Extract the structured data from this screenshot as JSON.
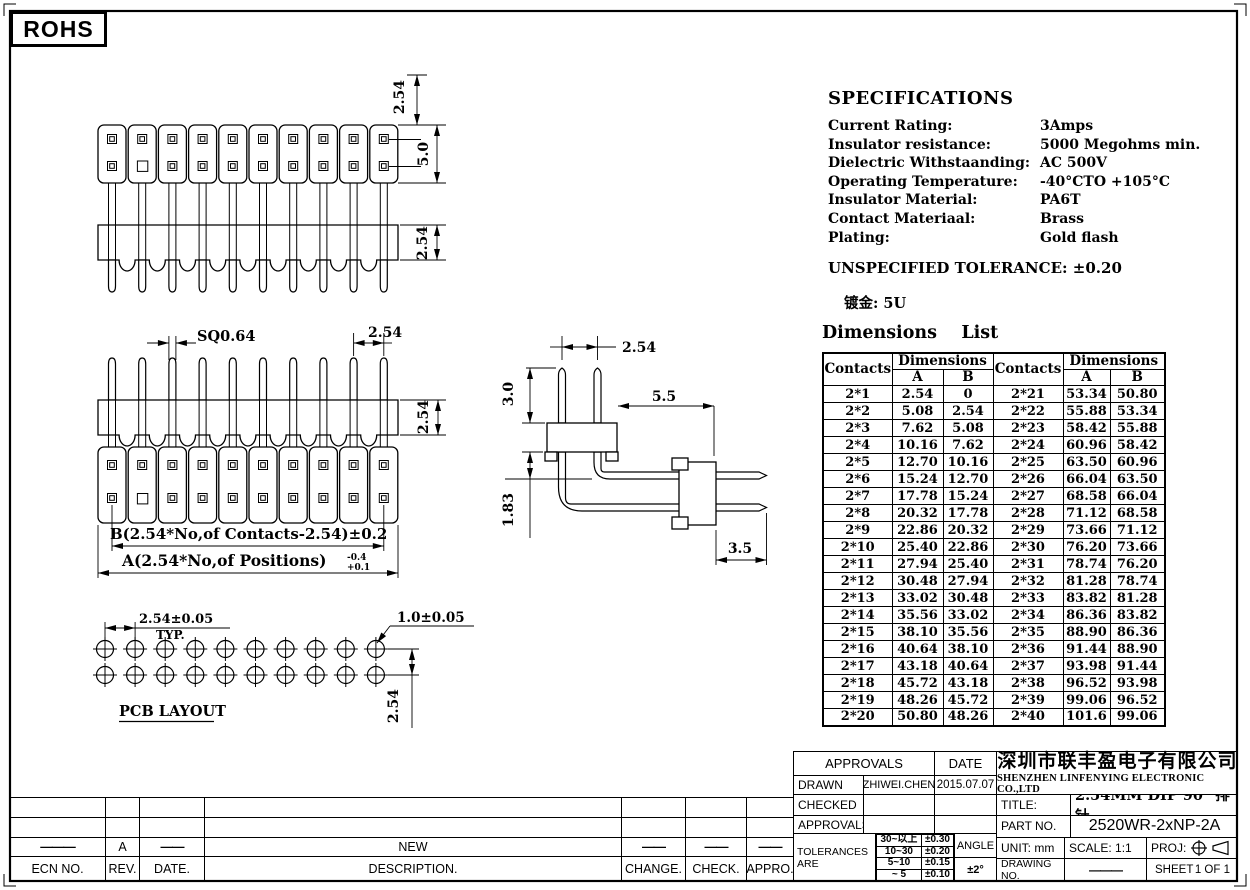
{
  "sheet": {
    "rohs": "ROHS"
  },
  "specs": {
    "title": "SPECIFICATIONS",
    "rows": [
      {
        "label": "Current Rating:",
        "value": "3Amps"
      },
      {
        "label": "Insulator resistance:",
        "value": "5000 Megohms min."
      },
      {
        "label": "Dielectric Withstaanding:",
        "value": "AC 500V"
      },
      {
        "label": "Operating Temperature:",
        "value": "-40°CTO +105°C"
      },
      {
        "label": "Insulator Material:",
        "value": "PA6T"
      },
      {
        "label": "Contact Materiaal:",
        "value": "Brass"
      },
      {
        "label": "Plating:",
        "value": "Gold flash"
      }
    ],
    "unspecified_tolerance": "UNSPECIFIED TOLERANCE: ±0.20",
    "plating_note": "镀金: 5U"
  },
  "dimensions_list": {
    "title": "Dimensions    List",
    "col_contacts": "Contacts",
    "col_dimensions": "Dimensions",
    "col_a": "A",
    "col_b": "B",
    "rows": [
      [
        "2*1",
        "2.54",
        "0",
        "2*21",
        "53.34",
        "50.80"
      ],
      [
        "2*2",
        "5.08",
        "2.54",
        "2*22",
        "55.88",
        "53.34"
      ],
      [
        "2*3",
        "7.62",
        "5.08",
        "2*23",
        "58.42",
        "55.88"
      ],
      [
        "2*4",
        "10.16",
        "7.62",
        "2*24",
        "60.96",
        "58.42"
      ],
      [
        "2*5",
        "12.70",
        "10.16",
        "2*25",
        "63.50",
        "60.96"
      ],
      [
        "2*6",
        "15.24",
        "12.70",
        "2*26",
        "66.04",
        "63.50"
      ],
      [
        "2*7",
        "17.78",
        "15.24",
        "2*27",
        "68.58",
        "66.04"
      ],
      [
        "2*8",
        "20.32",
        "17.78",
        "2*28",
        "71.12",
        "68.58"
      ],
      [
        "2*9",
        "22.86",
        "20.32",
        "2*29",
        "73.66",
        "71.12"
      ],
      [
        "2*10",
        "25.40",
        "22.86",
        "2*30",
        "76.20",
        "73.66"
      ],
      [
        "2*11",
        "27.94",
        "25.40",
        "2*31",
        "78.74",
        "76.20"
      ],
      [
        "2*12",
        "30.48",
        "27.94",
        "2*32",
        "81.28",
        "78.74"
      ],
      [
        "2*13",
        "33.02",
        "30.48",
        "2*33",
        "83.82",
        "81.28"
      ],
      [
        "2*14",
        "35.56",
        "33.02",
        "2*34",
        "86.36",
        "83.82"
      ],
      [
        "2*15",
        "38.10",
        "35.56",
        "2*35",
        "88.90",
        "86.36"
      ],
      [
        "2*16",
        "40.64",
        "38.10",
        "2*36",
        "91.44",
        "88.90"
      ],
      [
        "2*17",
        "43.18",
        "40.64",
        "2*37",
        "93.98",
        "91.44"
      ],
      [
        "2*18",
        "45.72",
        "43.18",
        "2*38",
        "96.52",
        "93.98"
      ],
      [
        "2*19",
        "48.26",
        "45.72",
        "2*39",
        "99.06",
        "96.52"
      ],
      [
        "2*20",
        "50.80",
        "48.26",
        "2*40",
        "101.6",
        "99.06"
      ]
    ]
  },
  "drawings": {
    "front_view": {
      "pin_dim": "2.54",
      "body_dim": "5.0",
      "base_dim": "2.54"
    },
    "back_view": {
      "sq_dim": "SQ0.64",
      "pitch_dim": "2.54",
      "base_dim": "2.54",
      "b_formula": "B(2.54*No,of Contacts-2.54)±0.2",
      "a_formula": "A(2.54*No,of Positions)",
      "a_tol_upper": "-0.4",
      "a_tol_lower": "+0.1"
    },
    "side_view": {
      "pitch_dim": "2.54",
      "height_dim": "3.0",
      "length_dim": "5.5",
      "offset_dim": "1.83",
      "tail_dim": "3.5"
    },
    "pcb_layout": {
      "pitch_dim": "2.54±0.05",
      "typ": "TYP.",
      "hole_dim": "1.0±0.05",
      "row_dim": "2.54",
      "caption": "PCB LAYOUT"
    }
  },
  "revision_table": {
    "entry": {
      "ecn": "———",
      "rev": "A",
      "date": "——",
      "description": "NEW",
      "change": "——",
      "check": "——",
      "appro": "——"
    },
    "headers": {
      "ecn": "ECN NO.",
      "rev": "REV.",
      "date": "DATE.",
      "description": "DESCRIPTION.",
      "change": "CHANGE.",
      "check": "CHECK.",
      "appro": "APPRO."
    }
  },
  "title_block": {
    "approvals_header": "APPROVALS",
    "date_header": "DATE",
    "drawn_label": "DRAWN",
    "drawn_name": "ZHIWEI.CHEN",
    "drawn_date": "2015.07.07",
    "checked_label": "CHECKED",
    "approvals_label": "APPROVALS",
    "tolerances_label": "TOLERANCES ARE",
    "tolerance_rows": [
      [
        "30~以上",
        "±0.30"
      ],
      [
        "10~30",
        "±0.20"
      ],
      [
        "5~10",
        "±0.15"
      ],
      [
        "~ 5",
        "±0.10"
      ]
    ],
    "angle_label": "ANGLE",
    "angle_value": "±2°",
    "company_cn": "深圳市联丰盈电子有限公司",
    "company_en": "SHENZHEN LINFENYING ELECTRONIC CO.,LTD",
    "title_label": "TITLE:",
    "title_value": "2.54MM DIP 90° 排针",
    "part_no_label": "PART NO.",
    "part_no_value": "2520WR-2xNP-2A",
    "unit_label": "UNIT: mm",
    "scale_label": "SCALE: 1:1",
    "proj_label": "PROJ:",
    "drawing_no_label": "DRAWING NO.",
    "drawing_no_value": "———",
    "sheet_label": "SHEET",
    "sheet_value": "1 OF 1"
  }
}
